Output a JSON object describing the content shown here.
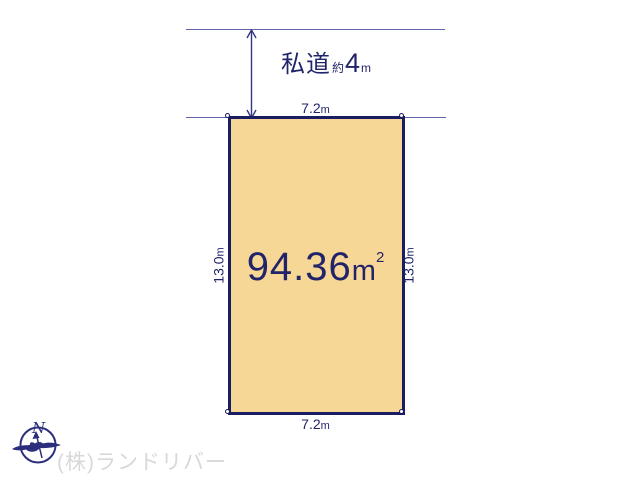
{
  "diagram": {
    "road": {
      "name": "私道",
      "approx_prefix": "約",
      "width_value": "4",
      "width_unit": "m"
    },
    "plot": {
      "area_value": "94.36",
      "area_unit_base": "m",
      "area_unit_sup": "2",
      "top_width_value": "7.2",
      "bottom_width_value": "7.2",
      "left_depth_value": "13.0",
      "right_depth_value": "13.0",
      "dim_unit": "m"
    },
    "compass": {
      "north_label": "N"
    },
    "watermark": {
      "company": "(株)ランドリバー"
    },
    "colors": {
      "plot_fill": "#F7D795",
      "outline_navy": "#1B1D63",
      "line_navy": "#6366A8",
      "arrow_navy": "#34377F",
      "text_navy": "#22246A",
      "watermark_gray": "#D8D8D8"
    }
  }
}
